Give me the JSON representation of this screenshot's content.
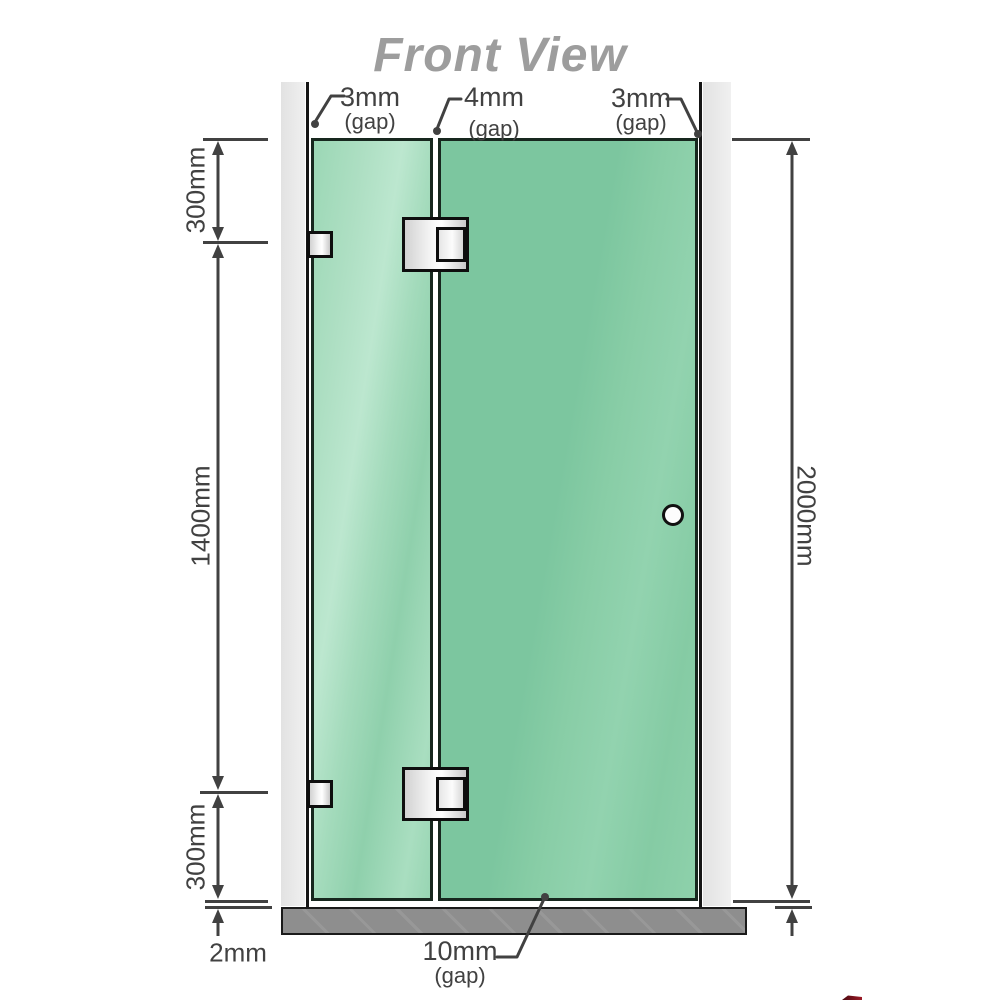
{
  "title": "Front View",
  "annotations": {
    "gap_top_left": {
      "value": "3mm",
      "qualifier": "(gap)"
    },
    "gap_top_middle": {
      "value": "4mm",
      "qualifier": "(gap)"
    },
    "gap_top_right": {
      "value": "3mm",
      "qualifier": "(gap)"
    },
    "gap_bottom": {
      "value": "10mm",
      "qualifier": "(gap)"
    }
  },
  "dimensions": {
    "left_top": "300mm",
    "left_middle": "1400mm",
    "left_bottom": "300mm",
    "base_gap": "2mm",
    "right_total": "2000mm"
  },
  "colors": {
    "glass_green": "#7cc69f",
    "glass_light": "#b9e6cb",
    "wall_gray": "#e8e8e8",
    "base_gray": "#8e8e8e",
    "dimension_gray": "#414141",
    "title_gray": "#9d9d9d",
    "logo_red": "#9c1a26"
  }
}
